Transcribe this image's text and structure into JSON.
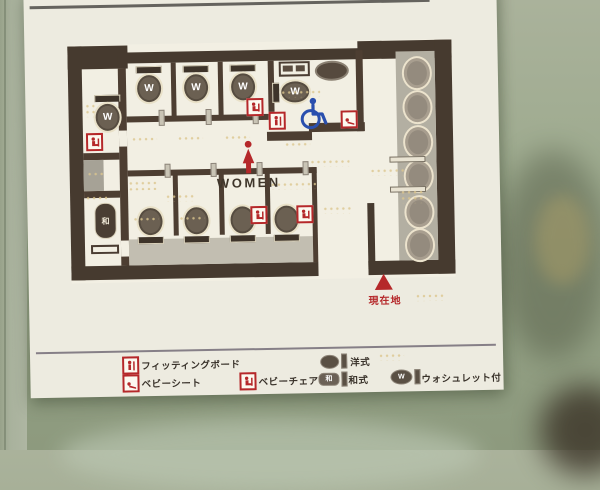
{
  "sign": {
    "map": {
      "area_label": "WOMEN",
      "you_are_here_label": "現在地",
      "washlet_letter": "W",
      "japanese_style_char": "和"
    },
    "legend": {
      "items": [
        {
          "id": "fitting-board",
          "label": "フィッティングボード"
        },
        {
          "id": "baby-sheet",
          "label": "ベビーシート"
        },
        {
          "id": "baby-chair",
          "label": "ベビーチェア"
        },
        {
          "id": "western-style",
          "label": "洋式"
        },
        {
          "id": "japanese-style",
          "label": "和式"
        },
        {
          "id": "washlet",
          "label": "ウォシュレット付"
        }
      ]
    },
    "colors": {
      "accent_red": "#b5282a",
      "wheelchair_blue": "#2a4fae",
      "wall_brown": "#46382e",
      "panel_white": "#edebe0",
      "background_green": "#9daa8e"
    }
  }
}
